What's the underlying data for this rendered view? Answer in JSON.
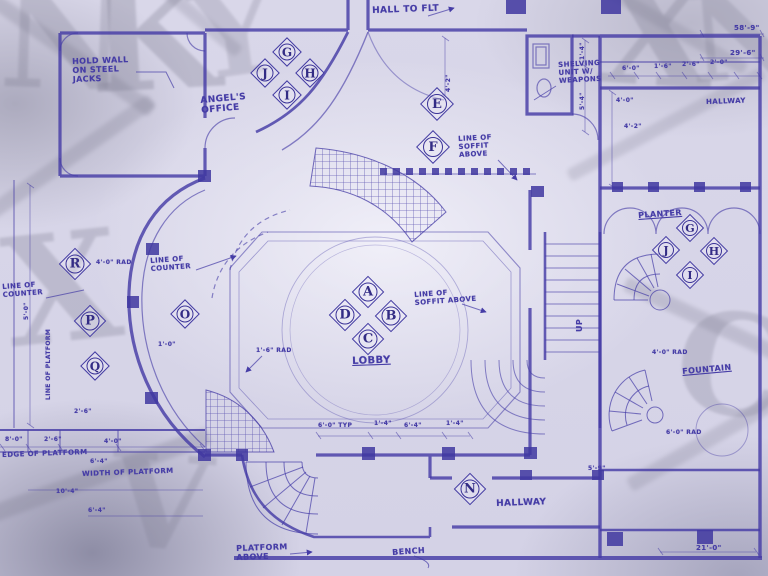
{
  "document": {
    "type": "hand-drawn architectural blueprint, hotel lobby floor plan",
    "main_room": "LOBBY"
  },
  "colors": {
    "ink": "#453CA6",
    "ink_dark": "#332c85",
    "paper": "#d9d7e9",
    "watermark_gray": "#7d7c90"
  },
  "labels": [
    {
      "name": "room-label-hall-to-flt",
      "text": "HALL TO FLT",
      "x": 372,
      "y": 6,
      "s": 9,
      "rot": -2
    },
    {
      "name": "note-hold-wall",
      "text": "HOLD WALL\nON STEEL\nJACKS",
      "x": 72,
      "y": 58,
      "s": 8,
      "rot": -2
    },
    {
      "name": "room-label-angels-office",
      "text": "ANGEL'S\nOFFICE",
      "x": 200,
      "y": 96,
      "s": 9,
      "rot": -5
    },
    {
      "name": "note-shelving",
      "text": "SHELVING\nUNIT W/\nWEAPONS",
      "x": 558,
      "y": 62,
      "s": 7,
      "rot": -3
    },
    {
      "name": "note-line-of-soffit-1",
      "text": "LINE OF\nSOFFIT\nABOVE",
      "x": 458,
      "y": 136,
      "s": 7,
      "rot": -3
    },
    {
      "name": "note-line-of-counter-1",
      "text": "LINE OF\nCOUNTER",
      "x": 150,
      "y": 258,
      "s": 7,
      "rot": -4
    },
    {
      "name": "note-line-of-counter-2",
      "text": "LINE OF\nCOUNTER",
      "x": 2,
      "y": 284,
      "s": 7,
      "rot": -4
    },
    {
      "name": "note-line-of-soffit-2",
      "text": "LINE OF\nSOFFIT ABOVE",
      "x": 414,
      "y": 292,
      "s": 7,
      "rot": -4
    },
    {
      "name": "room-label-lobby",
      "text": "LOBBY",
      "x": 352,
      "y": 356,
      "s": 10,
      "rot": -2,
      "u": true
    },
    {
      "name": "room-label-planter",
      "text": "PLANTER",
      "x": 638,
      "y": 212,
      "s": 8,
      "rot": -4,
      "u": true
    },
    {
      "name": "room-label-hallway-top-right",
      "text": "HALLWAY",
      "x": 706,
      "y": 99,
      "s": 7,
      "rot": -2
    },
    {
      "name": "room-label-fountain",
      "text": "FOUNTAIN",
      "x": 682,
      "y": 368,
      "s": 8,
      "rot": -5,
      "u": true
    },
    {
      "name": "room-label-hallway-bottom",
      "text": "HALLWAY",
      "x": 496,
      "y": 499,
      "s": 9,
      "rot": -2
    },
    {
      "name": "note-platform-above",
      "text": "PLATFORM\nABOVE",
      "x": 236,
      "y": 545,
      "s": 8,
      "rot": -2
    },
    {
      "name": "note-bench",
      "text": "BENCH",
      "x": 392,
      "y": 549,
      "s": 8,
      "rot": -4
    },
    {
      "name": "note-edge-of-platform",
      "text": "EDGE OF PLATFORM",
      "x": 2,
      "y": 452,
      "s": 7,
      "rot": -2
    },
    {
      "name": "note-width-of-platform",
      "text": "WIDTH OF PLATFORM",
      "x": 82,
      "y": 471,
      "s": 7,
      "rot": -2
    },
    {
      "name": "note-line-of-platform",
      "text": "LINE OF PLATFORM",
      "x": 46,
      "y": 400,
      "s": 6,
      "rot": -90
    },
    {
      "name": "stair-direction-up",
      "text": "UP",
      "x": 576,
      "y": 332,
      "s": 8,
      "rot": -90
    },
    {
      "name": "dim-58-9",
      "text": "58'-9\"",
      "x": 734,
      "y": 25,
      "s": 7
    },
    {
      "name": "dim-29-6",
      "text": "29'-6\"",
      "x": 730,
      "y": 50,
      "s": 7
    },
    {
      "name": "dim-6-0",
      "text": "6'-0\"",
      "x": 622,
      "y": 66,
      "s": 6
    },
    {
      "name": "dim-1-6",
      "text": "1'-6\"",
      "x": 654,
      "y": 64,
      "s": 6
    },
    {
      "name": "dim-2-6-a",
      "text": "2'-6\"",
      "x": 682,
      "y": 62,
      "s": 6
    },
    {
      "name": "dim-2-0",
      "text": "2'-0\"",
      "x": 710,
      "y": 60,
      "s": 6
    },
    {
      "name": "dim-4-0-a",
      "text": "4'-0\"",
      "x": 616,
      "y": 98,
      "s": 6
    },
    {
      "name": "dim-4-2-a",
      "text": "4'-2\"",
      "x": 624,
      "y": 124,
      "s": 6
    },
    {
      "name": "dim-4-0-rad-left",
      "text": "4'-0\" RAD",
      "x": 96,
      "y": 260,
      "s": 6
    },
    {
      "name": "dim-1-0",
      "text": "1'-0\"",
      "x": 158,
      "y": 342,
      "s": 6
    },
    {
      "name": "dim-1-6-rad",
      "text": "1'-6\" RAD",
      "x": 256,
      "y": 348,
      "s": 6
    },
    {
      "name": "dim-4-0-rad-right",
      "text": "4'-0\" RAD",
      "x": 652,
      "y": 350,
      "s": 6
    },
    {
      "name": "dim-6-0-rad",
      "text": "6'-0\" RAD",
      "x": 666,
      "y": 430,
      "s": 6
    },
    {
      "name": "dim-6-0-typ",
      "text": "6'-0\" TYP",
      "x": 318,
      "y": 423,
      "s": 6
    },
    {
      "name": "dim-1-4-a",
      "text": "1'-4\"",
      "x": 374,
      "y": 421,
      "s": 6
    },
    {
      "name": "dim-6-4-a",
      "text": "6'-4\"",
      "x": 404,
      "y": 423,
      "s": 6
    },
    {
      "name": "dim-1-4-b",
      "text": "1'-4\"",
      "x": 446,
      "y": 421,
      "s": 6
    },
    {
      "name": "dim-2-6-b",
      "text": "2'-6\"",
      "x": 74,
      "y": 409,
      "s": 6
    },
    {
      "name": "dim-8-0",
      "text": "8'-0\"",
      "x": 5,
      "y": 437,
      "s": 6
    },
    {
      "name": "dim-2-6-c",
      "text": "2'-6\"",
      "x": 44,
      "y": 437,
      "s": 6
    },
    {
      "name": "dim-4-0-b",
      "text": "4'-0\"",
      "x": 104,
      "y": 439,
      "s": 6
    },
    {
      "name": "dim-6-4-b",
      "text": "6'-4\"",
      "x": 90,
      "y": 459,
      "s": 6
    },
    {
      "name": "dim-10-4",
      "text": "10'-4\"",
      "x": 56,
      "y": 489,
      "s": 6
    },
    {
      "name": "dim-6-4-c",
      "text": "6'-4\"",
      "x": 88,
      "y": 508,
      "s": 6
    },
    {
      "name": "dim-21-0",
      "text": "21'-0\"",
      "x": 696,
      "y": 545,
      "s": 7
    },
    {
      "name": "dim-5-9",
      "text": "5'-9\"",
      "x": 588,
      "y": 466,
      "s": 6
    },
    {
      "name": "dim-4-2-b",
      "text": "4'-2\"",
      "x": 446,
      "y": 92,
      "s": 6,
      "rot": -90
    },
    {
      "name": "dim-5-0",
      "text": "5'-0\"",
      "x": 24,
      "y": 320,
      "s": 6,
      "rot": -90
    },
    {
      "name": "dim-5-4",
      "text": "5'-4\"",
      "x": 580,
      "y": 110,
      "s": 6,
      "rot": -90
    },
    {
      "name": "dim-1-4-c",
      "text": "1'-4\"",
      "x": 580,
      "y": 60,
      "s": 6,
      "rot": -90
    }
  ],
  "callouts": [
    {
      "letter": "J",
      "x": 265,
      "y": 73,
      "s": 21
    },
    {
      "letter": "G",
      "x": 287,
      "y": 52,
      "s": 21
    },
    {
      "letter": "H",
      "x": 310,
      "y": 73,
      "s": 21
    },
    {
      "letter": "I",
      "x": 287,
      "y": 95,
      "s": 21
    },
    {
      "letter": "E",
      "x": 437,
      "y": 104,
      "s": 24
    },
    {
      "letter": "F",
      "x": 433,
      "y": 147,
      "s": 24
    },
    {
      "letter": "A",
      "x": 368,
      "y": 292,
      "s": 23
    },
    {
      "letter": "D",
      "x": 345,
      "y": 315,
      "s": 23
    },
    {
      "letter": "B",
      "x": 391,
      "y": 316,
      "s": 23
    },
    {
      "letter": "C",
      "x": 368,
      "y": 339,
      "s": 23
    },
    {
      "letter": "R",
      "x": 75,
      "y": 264,
      "s": 23
    },
    {
      "letter": "P",
      "x": 90,
      "y": 321,
      "s": 23
    },
    {
      "letter": "Q",
      "x": 95,
      "y": 366,
      "s": 21
    },
    {
      "letter": "O",
      "x": 185,
      "y": 314,
      "s": 21
    },
    {
      "letter": "N",
      "x": 470,
      "y": 489,
      "s": 23
    },
    {
      "letter": "J",
      "x": 666,
      "y": 250,
      "s": 20
    },
    {
      "letter": "G",
      "x": 690,
      "y": 228,
      "s": 20
    },
    {
      "letter": "H",
      "x": 714,
      "y": 251,
      "s": 20
    },
    {
      "letter": "I",
      "x": 690,
      "y": 275,
      "s": 20
    }
  ],
  "watermark": {
    "glyphs": [
      {
        "char": "K",
        "x": 88,
        "y": -38,
        "size": 150,
        "rot": -3,
        "op": 0.3
      },
      {
        "char": "N",
        "x": 0,
        "y": -30,
        "size": 140,
        "rot": 2,
        "op": 0.26
      },
      {
        "char": "Y",
        "x": 192,
        "y": -26,
        "size": 120,
        "rot": -8,
        "op": 0.24
      },
      {
        "char": "X",
        "x": 598,
        "y": -42,
        "size": 150,
        "rot": 4,
        "op": 0.28
      },
      {
        "char": "N",
        "x": 688,
        "y": -26,
        "size": 124,
        "rot": -5,
        "op": 0.24
      },
      {
        "char": "C",
        "x": 676,
        "y": 296,
        "size": 140,
        "rot": 8,
        "op": 0.26
      },
      {
        "char": "X",
        "x": 4,
        "y": 214,
        "size": 150,
        "rot": -6,
        "op": 0.28
      },
      {
        "char": "V",
        "x": 110,
        "y": 438,
        "size": 130,
        "rot": 5,
        "op": 0.24
      }
    ],
    "bars": [
      {
        "x": -30,
        "y": 46,
        "w": 200,
        "h": 15,
        "rot": 35,
        "op": 0.28
      },
      {
        "x": -30,
        "y": 150,
        "w": 200,
        "h": 15,
        "rot": -35,
        "op": 0.26
      },
      {
        "x": 540,
        "y": 8,
        "w": 220,
        "h": 13,
        "rot": 30,
        "op": 0.24
      },
      {
        "x": 556,
        "y": 118,
        "w": 220,
        "h": 13,
        "rot": -28,
        "op": 0.22
      },
      {
        "x": 80,
        "y": -12,
        "w": 180,
        "h": 13,
        "rot": 40,
        "op": 0.24
      },
      {
        "x": 616,
        "y": 318,
        "w": 200,
        "h": 15,
        "rot": 25,
        "op": 0.26
      },
      {
        "x": 616,
        "y": 428,
        "w": 200,
        "h": 15,
        "rot": -30,
        "op": 0.24
      },
      {
        "x": -24,
        "y": 468,
        "w": 240,
        "h": 17,
        "rot": -20,
        "op": 0.3
      }
    ]
  }
}
